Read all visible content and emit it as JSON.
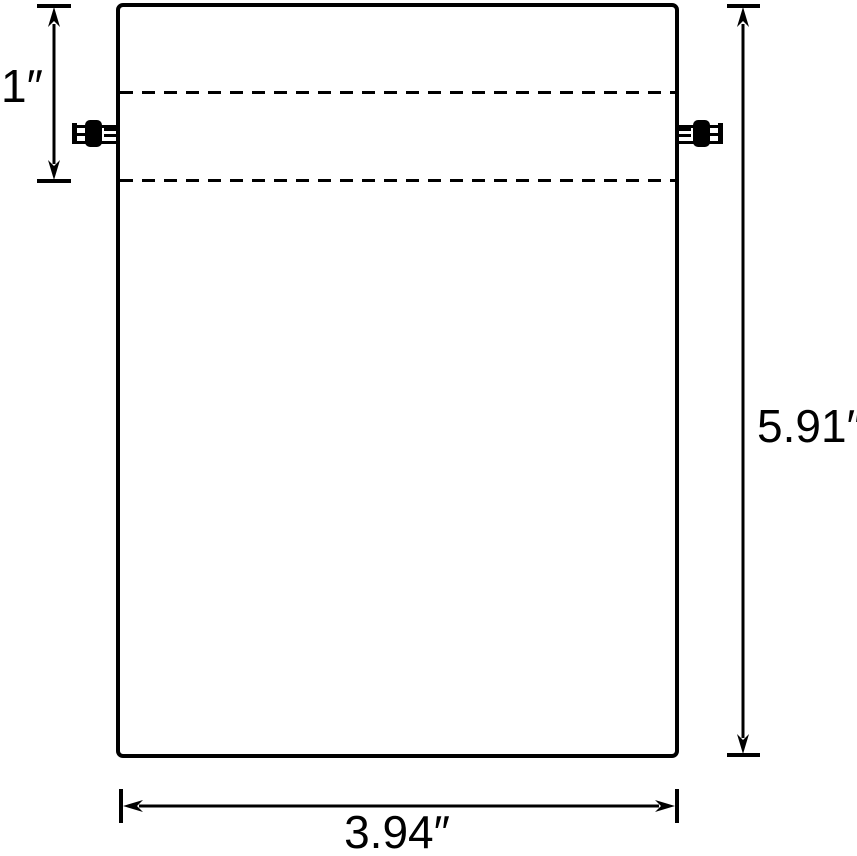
{
  "colors": {
    "background": "#ffffff",
    "line": "#000000"
  },
  "diagram": {
    "type": "dimensioned-drawing"
  },
  "icons": {
    "left_cord_lock": "cord-lock-icon",
    "right_cord_lock": "cord-lock-icon"
  },
  "dimensions": [
    {
      "id": "hem-height",
      "label": "1″",
      "orientation": "vertical",
      "side": "top-left"
    },
    {
      "id": "bag-height",
      "label": "5.91″",
      "orientation": "vertical",
      "side": "right"
    },
    {
      "id": "bag-width",
      "label": "3.94″",
      "orientation": "horizontal",
      "side": "bottom"
    }
  ]
}
